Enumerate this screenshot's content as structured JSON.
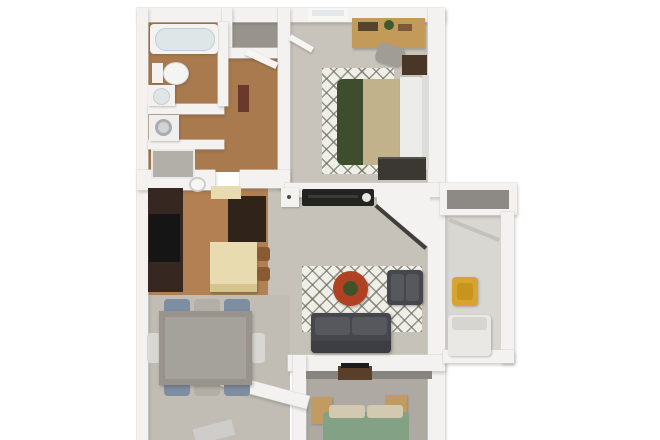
{
  "image": {
    "description": "3D rendered apartment floor plan, top-down view, centered on a white background, no text labels visible",
    "background_color": "#ffffff"
  },
  "palette": {
    "wall": "#f3f2f0",
    "wood": "#a97a4d",
    "woodLight": "#b28052",
    "carpet": "#c8c4bc",
    "carpetLiving": "#c6c2b9",
    "carpetDining": "#c1bdb5",
    "carpetDark": "#aeaaa3",
    "grayFloor": "#98948d",
    "patioFloor": "#d9d7d2",
    "roofInner": "#8d8a85",
    "cabinetDark": "#362820",
    "appliance": "#151515",
    "cream": "#e8dbb0",
    "stool": "#8a5a33",
    "sofa": "#45474c",
    "sofaCushion": "#56585d",
    "rug": "#efeee8",
    "tableRed": "#b04122",
    "tableRedCenter": "#3e5428",
    "bedGreen": "#3e4e2c",
    "bedTan": "#c2b28c",
    "bedWhite": "#ecedeb",
    "bedSage": "#83a285",
    "pillowTan": "#d2c9b0",
    "oakDesk": "#c49a5b",
    "nightstandDark": "#4a3626",
    "nightstandTan": "#c29b62",
    "dresserDark": "#3b3833",
    "chairBlue": "#7d8da2",
    "chairTan": "#b3afa7",
    "chairWhite": "#d8d7d3",
    "tableGray": "#98948d",
    "yellowChair": "#d7a42f",
    "tubWater": "#dfe6e8",
    "maroonCabinet": "#6b382c",
    "mediaBlack": "#232321",
    "tvBrown": "#5a3f28"
  },
  "rooms": [
    {
      "name": "bathroom"
    },
    {
      "name": "laundry-storage"
    },
    {
      "name": "walk-in-closet"
    },
    {
      "name": "hallway"
    },
    {
      "name": "master-bedroom"
    },
    {
      "name": "kitchen"
    },
    {
      "name": "living-room"
    },
    {
      "name": "dining-area"
    },
    {
      "name": "entry"
    },
    {
      "name": "second-bedroom"
    },
    {
      "name": "patio-balcony"
    }
  ],
  "furniture": [
    "bathtub",
    "toilet",
    "vanity-sink",
    "washer",
    "storage-closet",
    "hall-cabinet",
    "closet-door",
    "bedroom-door",
    "bedroom-window",
    "desk",
    "desk-chair",
    "bedroom-rug",
    "bed-master",
    "nightstand",
    "dresser",
    "plant",
    "tv-cabinet",
    "media-console",
    "living-rug",
    "coffee-table",
    "armchair",
    "sofa",
    "kitchen-cabinets",
    "range",
    "fridge",
    "upper-cabinet",
    "kitchen-island",
    "bar-stool",
    "kitchen-sink",
    "dining-table",
    "dining-chair",
    "second-bed",
    "tv-console",
    "patio-chair",
    "patio-lounge",
    "entry-door"
  ]
}
